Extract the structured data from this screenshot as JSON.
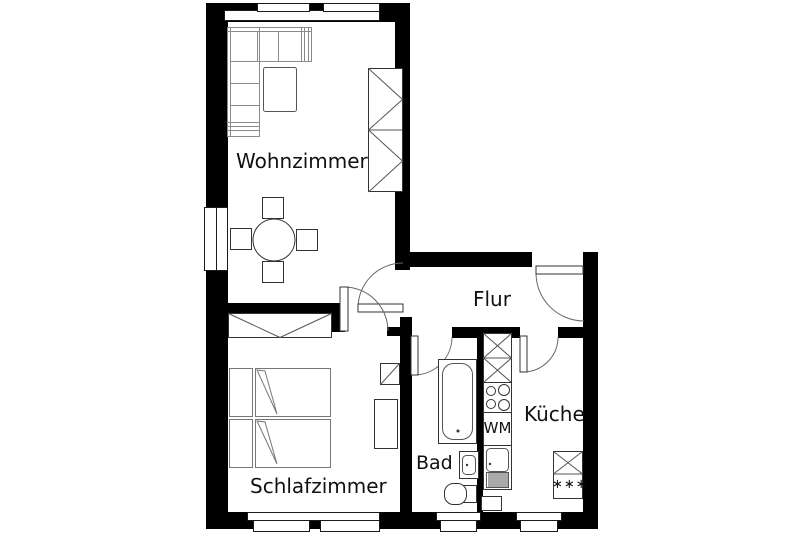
{
  "plan_title": "apartment-floor-plan",
  "colors": {
    "wall": "#000000",
    "line": "#1a1a1a",
    "furniture_line": "#8a8a8a",
    "background": "#ffffff"
  },
  "rooms": {
    "wohnzimmer": {
      "label": "Wohnzimmer"
    },
    "schlafzimmer": {
      "label": "Schlafzimmer"
    },
    "flur": {
      "label": "Flur"
    },
    "bad": {
      "label": "Bad"
    },
    "kueche": {
      "label": "Küche"
    }
  },
  "appliances": {
    "washing_machine": {
      "label": "WM"
    },
    "freezer": {
      "label": "∗∗∗"
    }
  }
}
